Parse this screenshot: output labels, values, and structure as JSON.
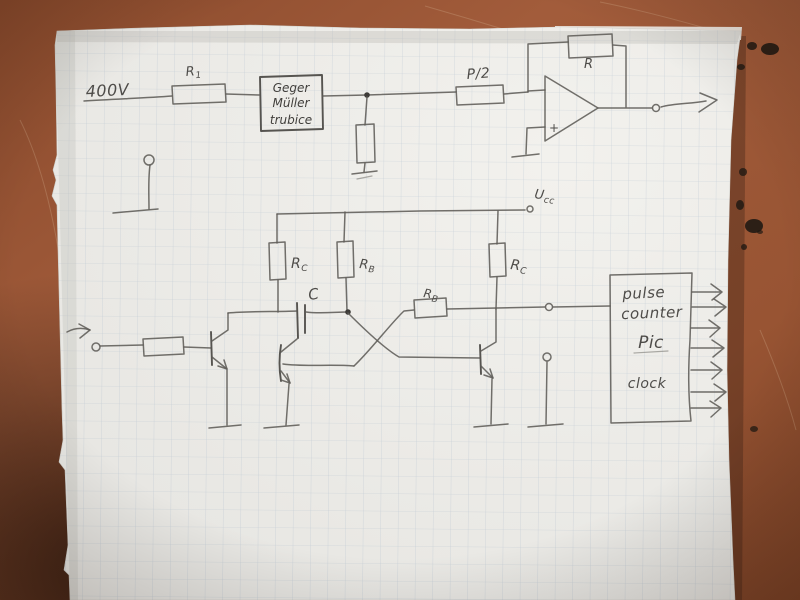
{
  "photo": {
    "labels": {
      "supply": "400V",
      "r1": {
        "base": "R",
        "sub": "1"
      },
      "tube": {
        "line1": "Geger",
        "line2": "Müller",
        "line3": "trubice"
      },
      "p2": "P/2",
      "feedback_r": "R",
      "opamp_plus": "+",
      "ucc": {
        "base": "U",
        "sub": "cc"
      },
      "rc_left": {
        "base": "R",
        "sub": "C"
      },
      "rb_top": {
        "base": "R",
        "sub": "B"
      },
      "cap": "C",
      "rb_coupling": {
        "base": "R",
        "sub": "B"
      },
      "rc_right": {
        "base": "R",
        "sub": "C"
      },
      "counter_box": {
        "line1": "pulse",
        "line2": "counter",
        "line3": "Pic",
        "line4": "clock"
      }
    },
    "colors": {
      "pencil": "#5e5c58",
      "paper": "#e8e7e3",
      "grid": "#9fb0c4",
      "table": "#9c5736",
      "ink_smudge": "#201913"
    }
  }
}
